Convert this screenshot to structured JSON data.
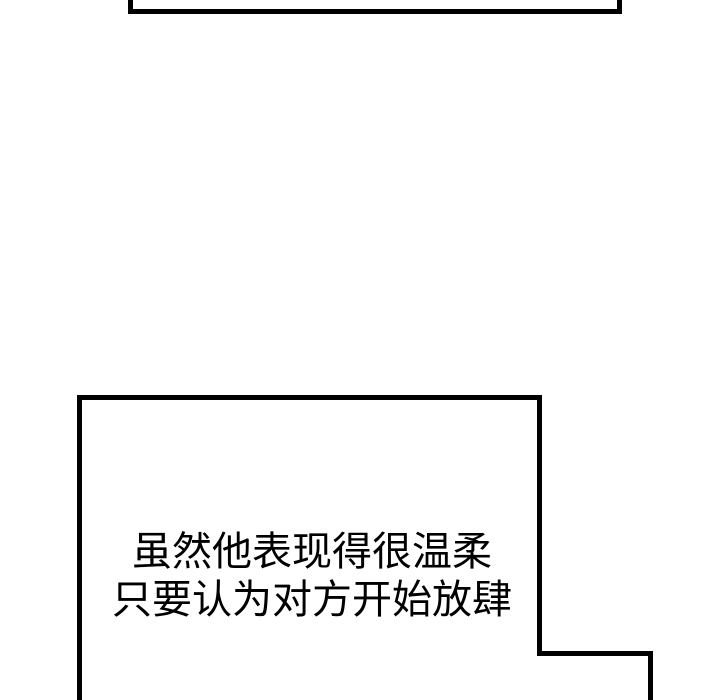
{
  "meta": {
    "background_color": "#ffffff",
    "panel_line_color": "#000000",
    "text_color": "#000000"
  },
  "caption": {
    "lines": {
      "0": "虽然他表现得很温柔",
      "1": "只要认为对方开始放肆"
    }
  }
}
